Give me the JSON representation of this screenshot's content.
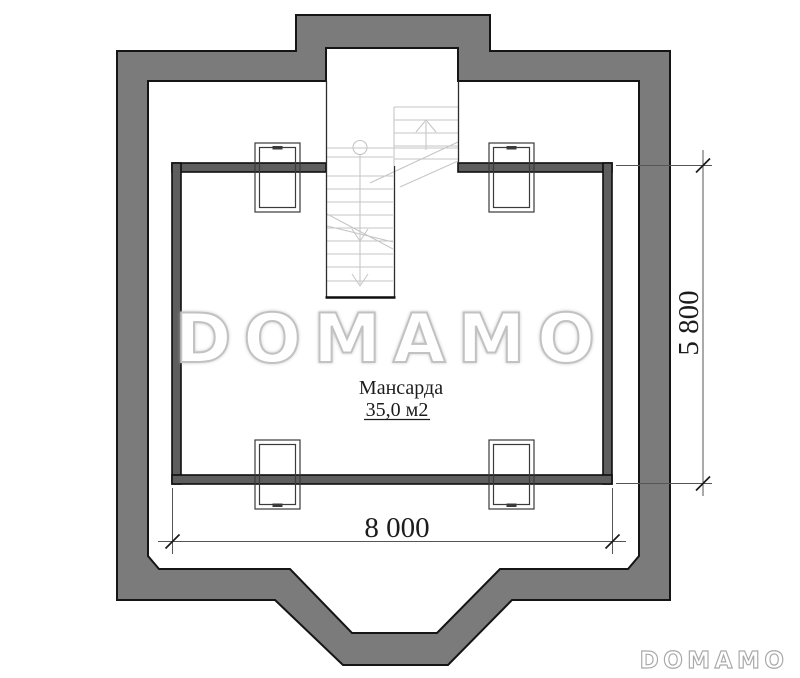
{
  "room": {
    "name": "Мансарда",
    "area": "35,0 м2"
  },
  "dimensions": {
    "width": "8 000",
    "height": "5 800"
  },
  "watermarks": {
    "large": "DOMAMO",
    "small": "DOMAMO"
  },
  "windows": {
    "count": 4,
    "positions": [
      "top-left",
      "top-right",
      "bottom-left",
      "bottom-right"
    ]
  },
  "stair": {
    "flights": 2,
    "direction_arrows": [
      "up",
      "down"
    ]
  },
  "colors": {
    "background": "#ffffff",
    "outer_wall_fill": "#7b7b7b",
    "outer_wall_outline": "#151515",
    "room_wall_fill": "#5e5e5e",
    "stair_lines": "#c6c6c6",
    "dimension_lines": "#555555",
    "text": "#1c1c1c",
    "watermark_large_stroke": "#c2c2c2",
    "watermark_small_stroke": "#a8a8a8"
  }
}
